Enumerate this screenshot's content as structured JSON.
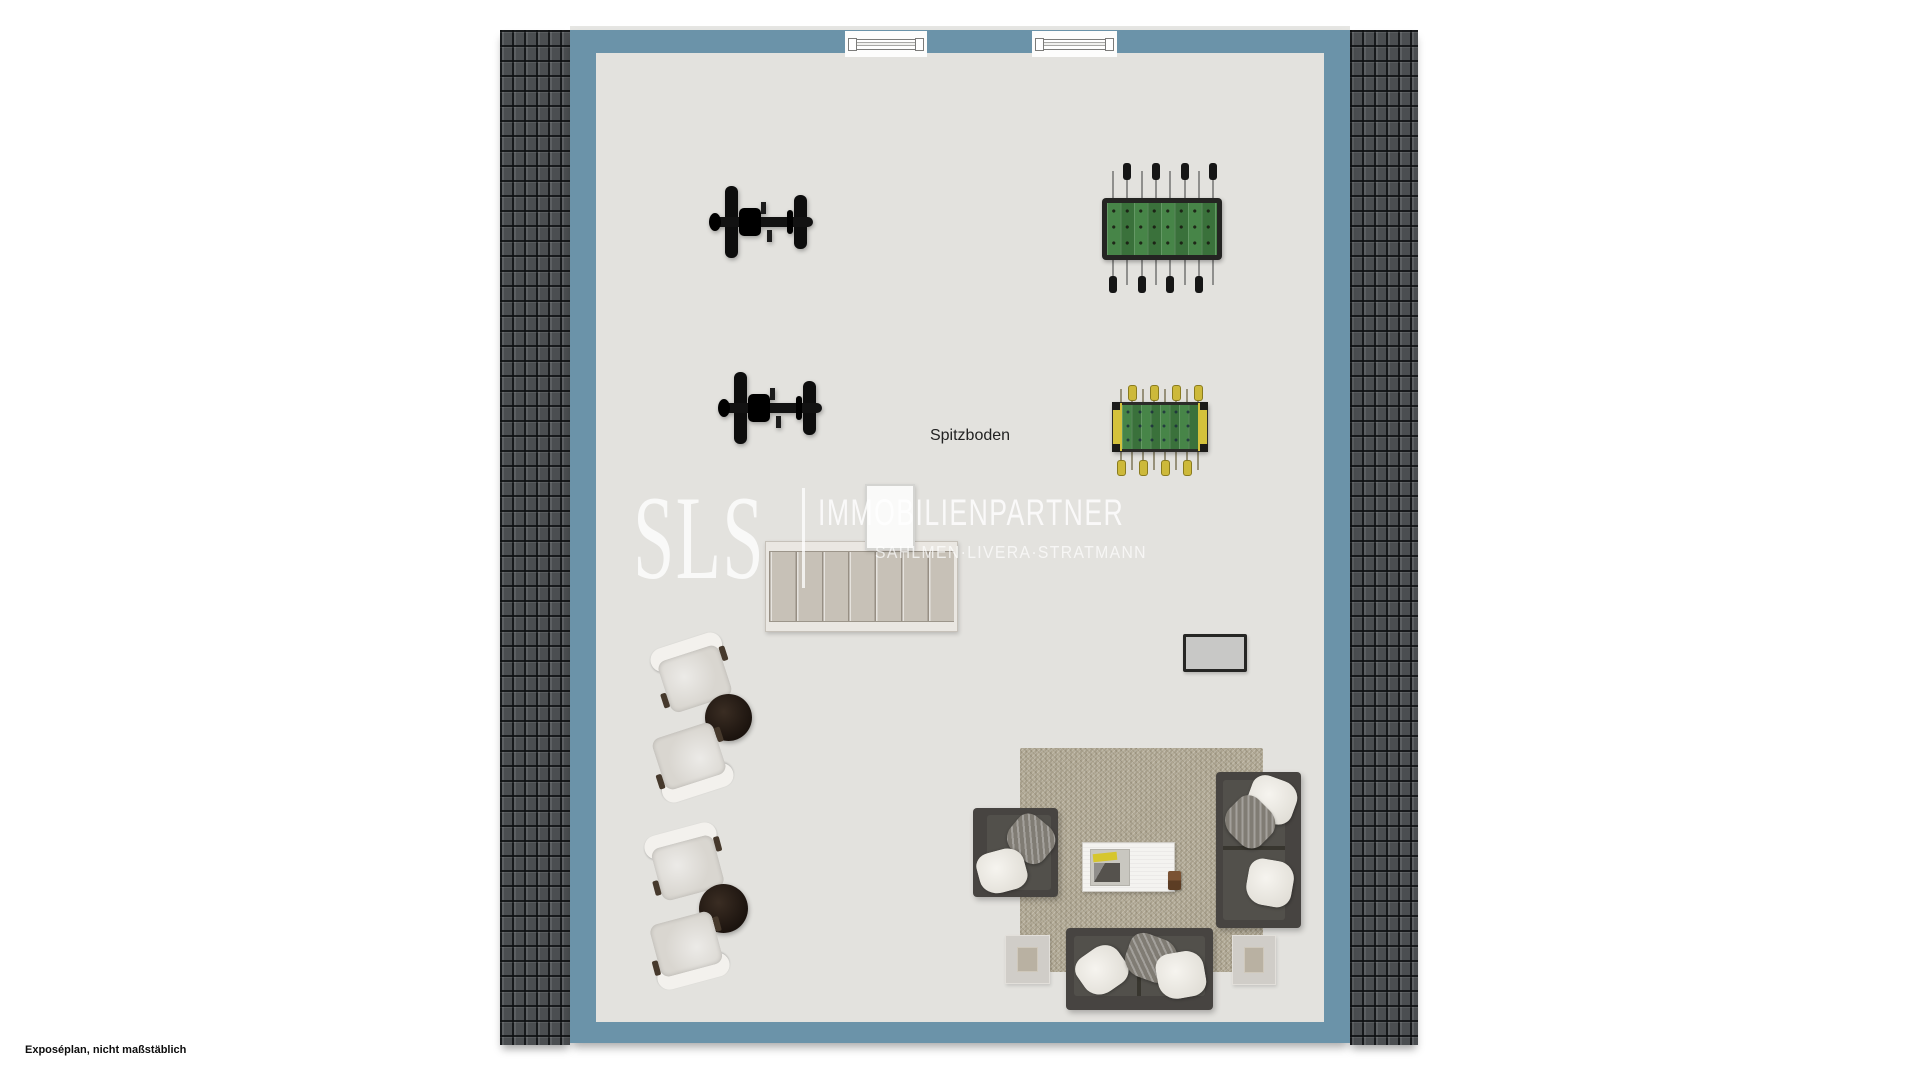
{
  "plan": {
    "room_label": "Spitzboden",
    "footer_note": "Exposéplan, nicht maßstäblich"
  },
  "watermark": {
    "brand": "SLS",
    "company": "IMMOBILIENPARTNER",
    "names": "SAHLMEN·LIVERA·STRATMANN"
  },
  "colors": {
    "wall_blue": "#6b93a9",
    "floor": "#e3e2de",
    "roof_tile": "#4b4e51",
    "rug_beige": "#b3ab97",
    "sofa_dark": "#474441",
    "foosball_green": "#3f7b40",
    "foosball_yellow": "#d4c23c",
    "round_table_brown": "#241a13"
  },
  "furniture_inventory": [
    {
      "item": "skylight-window",
      "count": 2
    },
    {
      "item": "exercise-bike",
      "count": 2
    },
    {
      "item": "foosball-table-black",
      "count": 1
    },
    {
      "item": "foosball-table-yellow",
      "count": 1
    },
    {
      "item": "staircase",
      "count": 1
    },
    {
      "item": "chimney-shaft",
      "count": 1
    },
    {
      "item": "tv-screen",
      "count": 1
    },
    {
      "item": "lounge-chair",
      "count": 4
    },
    {
      "item": "round-side-table",
      "count": 2
    },
    {
      "item": "armchair",
      "count": 1
    },
    {
      "item": "sofa",
      "count": 2
    },
    {
      "item": "rug",
      "count": 1
    },
    {
      "item": "coffee-table",
      "count": 1
    },
    {
      "item": "square-side-table",
      "count": 2
    }
  ]
}
